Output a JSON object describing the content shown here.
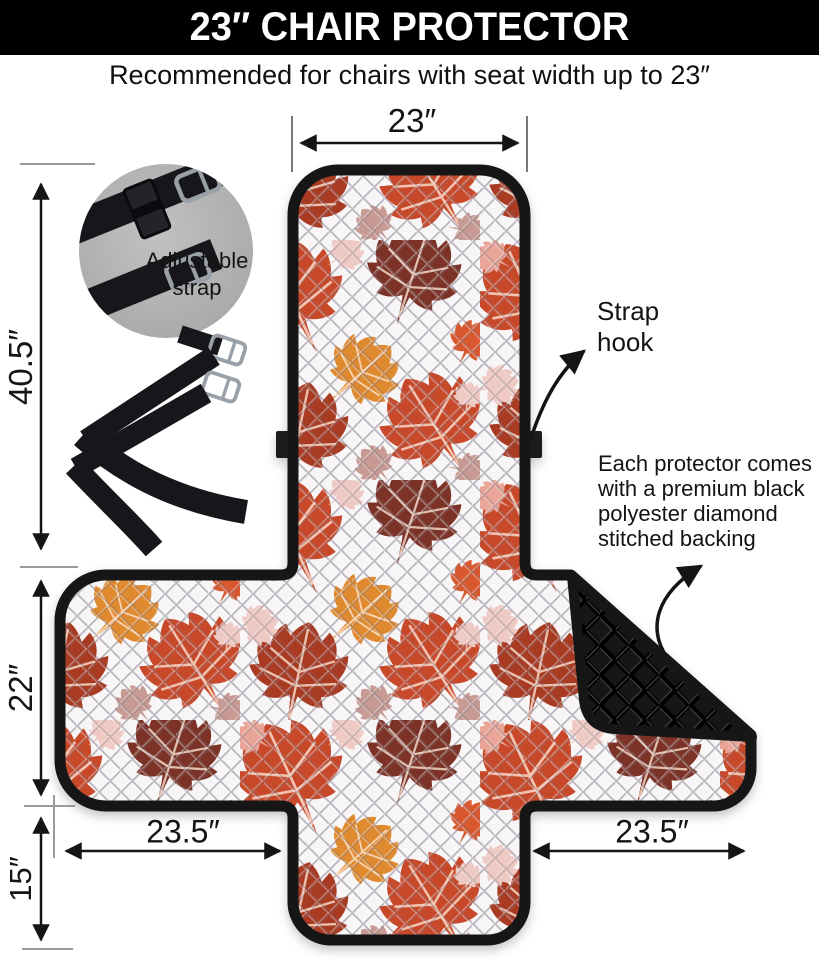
{
  "header": {
    "title": "23″ CHAIR PROTECTOR"
  },
  "subtitle": "Recommended for chairs with seat width up to 23″",
  "dimensions": {
    "top_width": "23″",
    "back_height": "40.5″",
    "seat_height": "22″",
    "front_skirt_height": "15″",
    "left_wing_width": "23.5″",
    "right_wing_width": "23.5″"
  },
  "annotations": {
    "adjustable_strap": {
      "lines": [
        "Adjustable",
        "strap"
      ]
    },
    "strap_hook": {
      "lines": [
        "Strap",
        "hook"
      ]
    },
    "backing_note": {
      "lines": [
        "Each protector comes",
        "with a premium black",
        "polyester diamond",
        "stitched backing"
      ]
    }
  },
  "product": {
    "fabric_pattern": "autumn-maple-leaves-quilted",
    "colors": {
      "leaf_red_orange": "#C8492A",
      "leaf_dark_red": "#A83A22",
      "leaf_maroon": "#7C3326",
      "leaf_orange": "#DF8A2F",
      "leaf_pink": "#EFC9C3",
      "leaf_mauve": "#C79B93",
      "backing_black": "#181818",
      "quilt_base": "#F7F5F6",
      "header_bg": "#000000",
      "strap_black": "#17171B"
    }
  }
}
